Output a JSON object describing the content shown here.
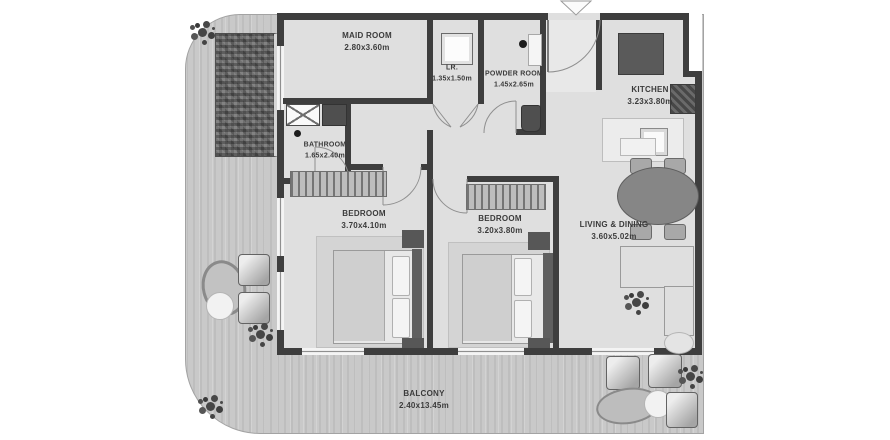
{
  "plan": {
    "title": "apartment-floor-plan",
    "rooms": [
      {
        "id": "maid-room",
        "name": "MAID ROOM",
        "dims": "2.80x3.60m"
      },
      {
        "id": "laundry-room",
        "name": "LR.",
        "dims": "1.35x1.50m"
      },
      {
        "id": "powder-room",
        "name": "POWDER ROOM",
        "dims": "1.45x2.65m"
      },
      {
        "id": "kitchen",
        "name": "KITCHEN",
        "dims": "3.23x3.80m"
      },
      {
        "id": "bathroom",
        "name": "BATHROOM",
        "dims": "1.65x2.40m"
      },
      {
        "id": "bedroom-1",
        "name": "BEDROOM",
        "dims": "3.70x4.10m"
      },
      {
        "id": "bedroom-2",
        "name": "BEDROOM",
        "dims": "3.20x3.80m"
      },
      {
        "id": "living-dining",
        "name": "LIVING & DINING",
        "dims": "3.60x5.02m"
      },
      {
        "id": "balcony",
        "name": "BALCONY",
        "dims": "2.40x13.45m"
      }
    ],
    "icons": {
      "entrance_marker": "triangle-down",
      "plants": "foliage-cluster"
    },
    "colors": {
      "wall": "#3e3e3e",
      "interior_floor": "#dfdfdf",
      "balcony_floor": "#c9c9c9",
      "pool_mosaic": "#6e6e6e",
      "label_text": "#3b3b3b"
    }
  }
}
